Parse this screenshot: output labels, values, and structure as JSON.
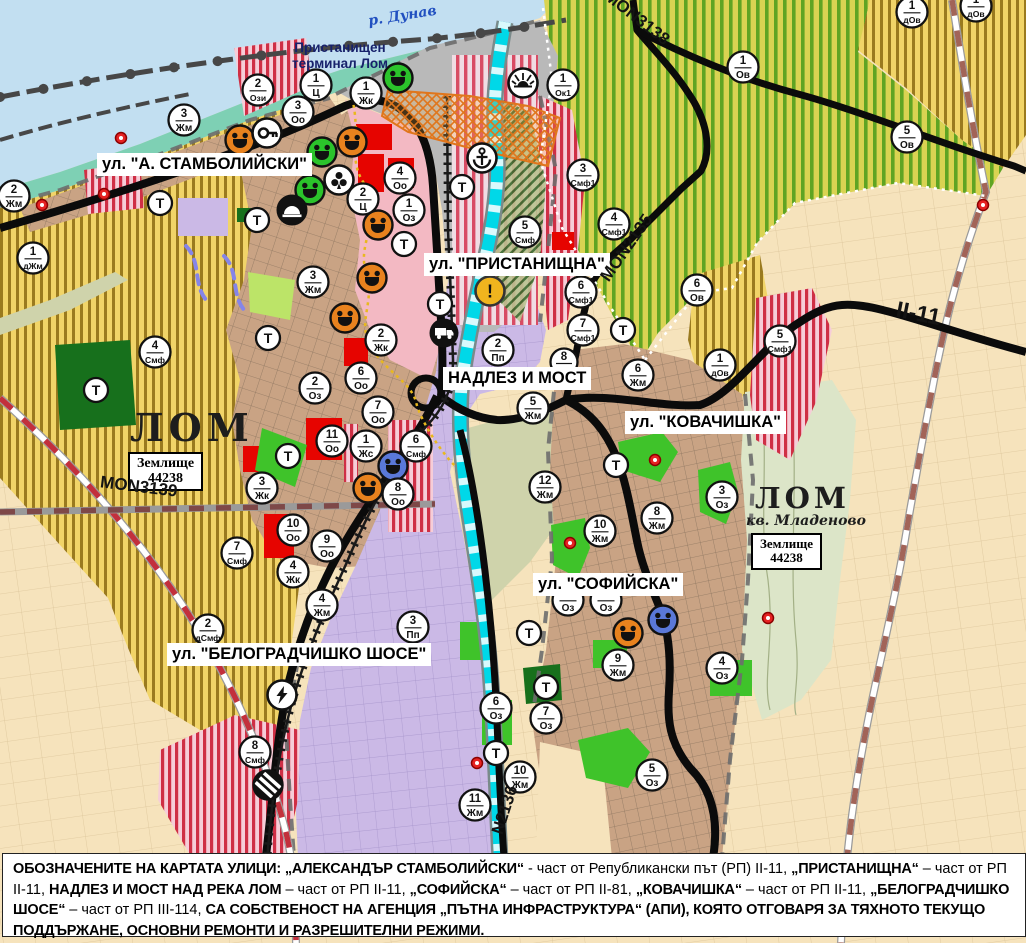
{
  "labels": {
    "river": "р. Дунав",
    "port_terminal": "Пристанищен\nтерминал Лом",
    "lom": "ЛОМ",
    "zemlishte": "Землище\n44238",
    "lom2": "ЛОМ",
    "kvartal": "кв. Младеново",
    "zemlishte2": "Землище\n44238"
  },
  "streets": {
    "stamboliyski": "ул. \"А. СТАМБОЛИЙСКИ\"",
    "pristanishtna": "ул. \"ПРИСТАНИЩНА\"",
    "nadlez": "НАДЛЕЗ И МОСТ",
    "kovachishka": "ул. \"КОВАЧИШКА\"",
    "sofiyska": "ул. \"СОФИЙСКА\"",
    "belogradchishko": "ул. \"БЕЛОГРАДЧИШКО ШОСЕ\""
  },
  "road_numbers": {
    "mon3138": "MON3138",
    "mon2135": "MON2135",
    "mon3139": "MON3139",
    "mon2136": "N2136",
    "ii11": "II-11"
  },
  "t_label": "Т",
  "markers": [
    {
      "n": "2",
      "c": "Ози",
      "x": 258,
      "y": 90
    },
    {
      "n": "1",
      "c": "Ц",
      "x": 316,
      "y": 85
    },
    {
      "n": "1",
      "c": "Жк",
      "x": 366,
      "y": 93
    },
    {
      "n": "3",
      "c": "Оо",
      "x": 298,
      "y": 112
    },
    {
      "n": "3",
      "c": "Жм",
      "x": 184,
      "y": 120
    },
    {
      "n": "2",
      "c": "Жм",
      "x": 14,
      "y": 196
    },
    {
      "n": "1",
      "c": "дЖм",
      "x": 33,
      "y": 258
    },
    {
      "n": "4",
      "c": "Оо",
      "x": 400,
      "y": 178
    },
    {
      "n": "2",
      "c": "Ц",
      "x": 363,
      "y": 199
    },
    {
      "n": "1",
      "c": "Оз",
      "x": 409,
      "y": 210
    },
    {
      "n": "1",
      "c": "Ок1",
      "x": 563,
      "y": 85
    },
    {
      "n": "3",
      "c": "Смф1",
      "x": 583,
      "y": 175
    },
    {
      "n": "4",
      "c": "Смф1",
      "x": 614,
      "y": 224
    },
    {
      "n": "5",
      "c": "Смф",
      "x": 525,
      "y": 232
    },
    {
      "n": "1",
      "c": "дОв",
      "x": 912,
      "y": 12
    },
    {
      "n": "1",
      "c": "дОв",
      "x": 976,
      "y": 6
    },
    {
      "n": "1",
      "c": "Ов",
      "x": 743,
      "y": 67
    },
    {
      "n": "5",
      "c": "Ов",
      "x": 907,
      "y": 137
    },
    {
      "n": "6",
      "c": "Ов",
      "x": 697,
      "y": 290
    },
    {
      "n": "3",
      "c": "Жм",
      "x": 313,
      "y": 282
    },
    {
      "n": "2",
      "c": "Жк",
      "x": 381,
      "y": 340
    },
    {
      "n": "2",
      "c": "Пп",
      "x": 498,
      "y": 350
    },
    {
      "n": "6",
      "c": "Оо",
      "x": 361,
      "y": 378
    },
    {
      "n": "2",
      "c": "Оз",
      "x": 315,
      "y": 388
    },
    {
      "n": "7",
      "c": "Оо",
      "x": 378,
      "y": 412
    },
    {
      "n": "11",
      "c": "Оо",
      "x": 332,
      "y": 441
    },
    {
      "n": "1",
      "c": "Жс",
      "x": 366,
      "y": 446
    },
    {
      "n": "6",
      "c": "Смф",
      "x": 416,
      "y": 446
    },
    {
      "n": "8",
      "c": "Оо",
      "x": 398,
      "y": 494
    },
    {
      "n": "4",
      "c": "Смф",
      "x": 155,
      "y": 352
    },
    {
      "n": "3",
      "c": "Жк",
      "x": 262,
      "y": 488
    },
    {
      "n": "10",
      "c": "Оо",
      "x": 293,
      "y": 530
    },
    {
      "n": "9",
      "c": "Оо",
      "x": 327,
      "y": 546
    },
    {
      "n": "7",
      "c": "Смф",
      "x": 237,
      "y": 553
    },
    {
      "n": "4",
      "c": "Жк",
      "x": 293,
      "y": 572
    },
    {
      "n": "4",
      "c": "Жм",
      "x": 322,
      "y": 605
    },
    {
      "n": "2",
      "c": "дСмф",
      "x": 208,
      "y": 630
    },
    {
      "n": "3",
      "c": "Пп",
      "x": 413,
      "y": 627
    },
    {
      "n": "8",
      "c": "Смф",
      "x": 255,
      "y": 752
    },
    {
      "n": "5",
      "c": "Жм",
      "x": 533,
      "y": 408
    },
    {
      "n": "6",
      "c": "Жм",
      "x": 638,
      "y": 375
    },
    {
      "n": "6",
      "c": "Смф1",
      "x": 581,
      "y": 292
    },
    {
      "n": "7",
      "c": "Смф1",
      "x": 583,
      "y": 330
    },
    {
      "n": "12",
      "c": "Жм",
      "x": 545,
      "y": 487
    },
    {
      "n": "10",
      "c": "Жм",
      "x": 600,
      "y": 531
    },
    {
      "n": "8",
      "c": "Жм",
      "x": 657,
      "y": 518
    },
    {
      "n": "3",
      "c": "Оз",
      "x": 722,
      "y": 497
    },
    {
      "n": "9",
      "c": "Жм",
      "x": 618,
      "y": 665
    },
    {
      "n": "4",
      "c": "Оз",
      "x": 722,
      "y": 668
    },
    {
      "n": "6",
      "c": "Оз",
      "x": 496,
      "y": 708
    },
    {
      "n": "7",
      "c": "Оз",
      "x": 546,
      "y": 718
    },
    {
      "n": "5",
      "c": "Оз",
      "x": 652,
      "y": 775
    },
    {
      "n": "10",
      "c": "Жм",
      "x": 520,
      "y": 777
    },
    {
      "n": "11",
      "c": "Жм",
      "x": 475,
      "y": 805
    },
    {
      "n": "5",
      "c": "Смф1",
      "x": 780,
      "y": 341
    },
    {
      "n": "1",
      "c": "дОв",
      "x": 720,
      "y": 365
    },
    {
      "n": "8",
      "c": "",
      "x": 564,
      "y": 362
    },
    {
      "n": "",
      "c": "Оз",
      "x": 568,
      "y": 600
    },
    {
      "n": "",
      "c": "Оз",
      "x": 606,
      "y": 600
    }
  ],
  "t_markers": [
    [
      160,
      203
    ],
    [
      257,
      220
    ],
    [
      268,
      338
    ],
    [
      96,
      390
    ],
    [
      404,
      244
    ],
    [
      440,
      304
    ],
    [
      462,
      187
    ],
    [
      623,
      330
    ],
    [
      616,
      465
    ],
    [
      288,
      456
    ],
    [
      529,
      633
    ],
    [
      546,
      687
    ],
    [
      496,
      753
    ]
  ],
  "icons": [
    {
      "type": "culture",
      "color": "orange",
      "x": 240,
      "y": 140
    },
    {
      "type": "culture",
      "color": "orange",
      "x": 352,
      "y": 142
    },
    {
      "type": "culture",
      "color": "orange",
      "x": 378,
      "y": 225
    },
    {
      "type": "culture",
      "color": "orange",
      "x": 372,
      "y": 278
    },
    {
      "type": "culture",
      "color": "orange",
      "x": 345,
      "y": 318
    },
    {
      "type": "culture",
      "color": "orange",
      "x": 368,
      "y": 488
    },
    {
      "type": "culture",
      "color": "orange",
      "x": 628,
      "y": 633
    },
    {
      "type": "culture",
      "color": "green",
      "x": 398,
      "y": 78
    },
    {
      "type": "culture",
      "color": "green",
      "x": 322,
      "y": 152
    },
    {
      "type": "culture",
      "color": "green",
      "x": 310,
      "y": 190
    },
    {
      "type": "culture",
      "color": "blue",
      "x": 393,
      "y": 466
    },
    {
      "type": "culture",
      "color": "blue",
      "x": 663,
      "y": 620
    },
    {
      "type": "key",
      "x": 267,
      "y": 133
    },
    {
      "type": "clover",
      "x": 339,
      "y": 180
    },
    {
      "type": "dome",
      "x": 292,
      "y": 210
    },
    {
      "type": "anchor",
      "x": 482,
      "y": 158
    },
    {
      "type": "sun",
      "x": 523,
      "y": 83
    },
    {
      "type": "truck",
      "x": 444,
      "y": 333
    },
    {
      "type": "warning",
      "x": 490,
      "y": 291
    },
    {
      "type": "lightning",
      "x": 282,
      "y": 695
    },
    {
      "type": "crossing",
      "x": 268,
      "y": 785
    }
  ],
  "red_dots": [
    [
      121,
      138
    ],
    [
      104,
      194
    ],
    [
      42,
      205
    ],
    [
      570,
      543
    ],
    [
      655,
      460
    ],
    [
      768,
      618
    ],
    [
      477,
      763
    ],
    [
      983,
      205
    ]
  ],
  "blue_rings": [
    [
      320,
      87
    ]
  ],
  "warning_glyph": "!",
  "caption": {
    "segments": [
      {
        "t": "ОБОЗНАЧЕНИТЕ НА КАРТАТА УЛИЦИ: „АЛЕКСАНДЪР СТАМБОЛИЙСКИ“",
        "b": true
      },
      {
        "t": " - част от Републикански път (РП) II-11, ",
        "b": false
      },
      {
        "t": "„ПРИСТАНИЩНА“",
        "b": true
      },
      {
        "t": " – част от РП II-11, ",
        "b": false
      },
      {
        "t": "НАДЛЕЗ И МОСТ НАД РЕКА ЛОМ",
        "b": true
      },
      {
        "t": " – част от РП II-11, ",
        "b": false
      },
      {
        "t": "„СОФИЙСКА“",
        "b": true
      },
      {
        "t": " – част от РП II-81, ",
        "b": false
      },
      {
        "t": "„КОВАЧИШКА“",
        "b": true
      },
      {
        "t": " – част от РП II-11, ",
        "b": false
      },
      {
        "t": "„БЕЛОГРАДЧИШКО ШОСЕ“",
        "b": true
      },
      {
        "t": " – част от РП III-114, ",
        "b": false
      },
      {
        "t": "СА СОБСТВЕНОСТ НА АГЕНЦИЯ „ПЪТНА ИНФРАСТРУКТУРА“ (АПИ), КОЯТО ОТГОВАРЯ ЗА ТЯХНОТО ТЕКУЩО ПОДДЪРЖАНЕ, ОСНОВНИ РЕМОНТИ И РАЗРЕШИТЕЛНИ РЕЖИМИ.",
        "b": true
      }
    ]
  },
  "colors": {
    "danube": "#c2dff1",
    "shore_teal": "#7ed0b4",
    "vineyard_bg": "#d9d352",
    "vineyard_stripe": "#5fa423",
    "yellow_bg": "#f1d468",
    "yellow_stripe": "#9a7a1f",
    "town_tan": "#c9a384",
    "lavender": "#cbb9e6",
    "pink_zone": "#f3b9c3",
    "smf_pink": "#f6cdd8",
    "smf_red": "#cf2f45",
    "red_zone": "#e60400",
    "green_park": "#3fc32a",
    "dark_green": "#17701c",
    "river_cyan": "#00d8e8",
    "road_black": "#0b0b0b",
    "red_dash_road": "#c2303c",
    "marker_orange": "#e8821e",
    "marker_green": "#2bc32b",
    "marker_blue": "#5a78d8",
    "warning_yellow": "#f0b41e"
  }
}
